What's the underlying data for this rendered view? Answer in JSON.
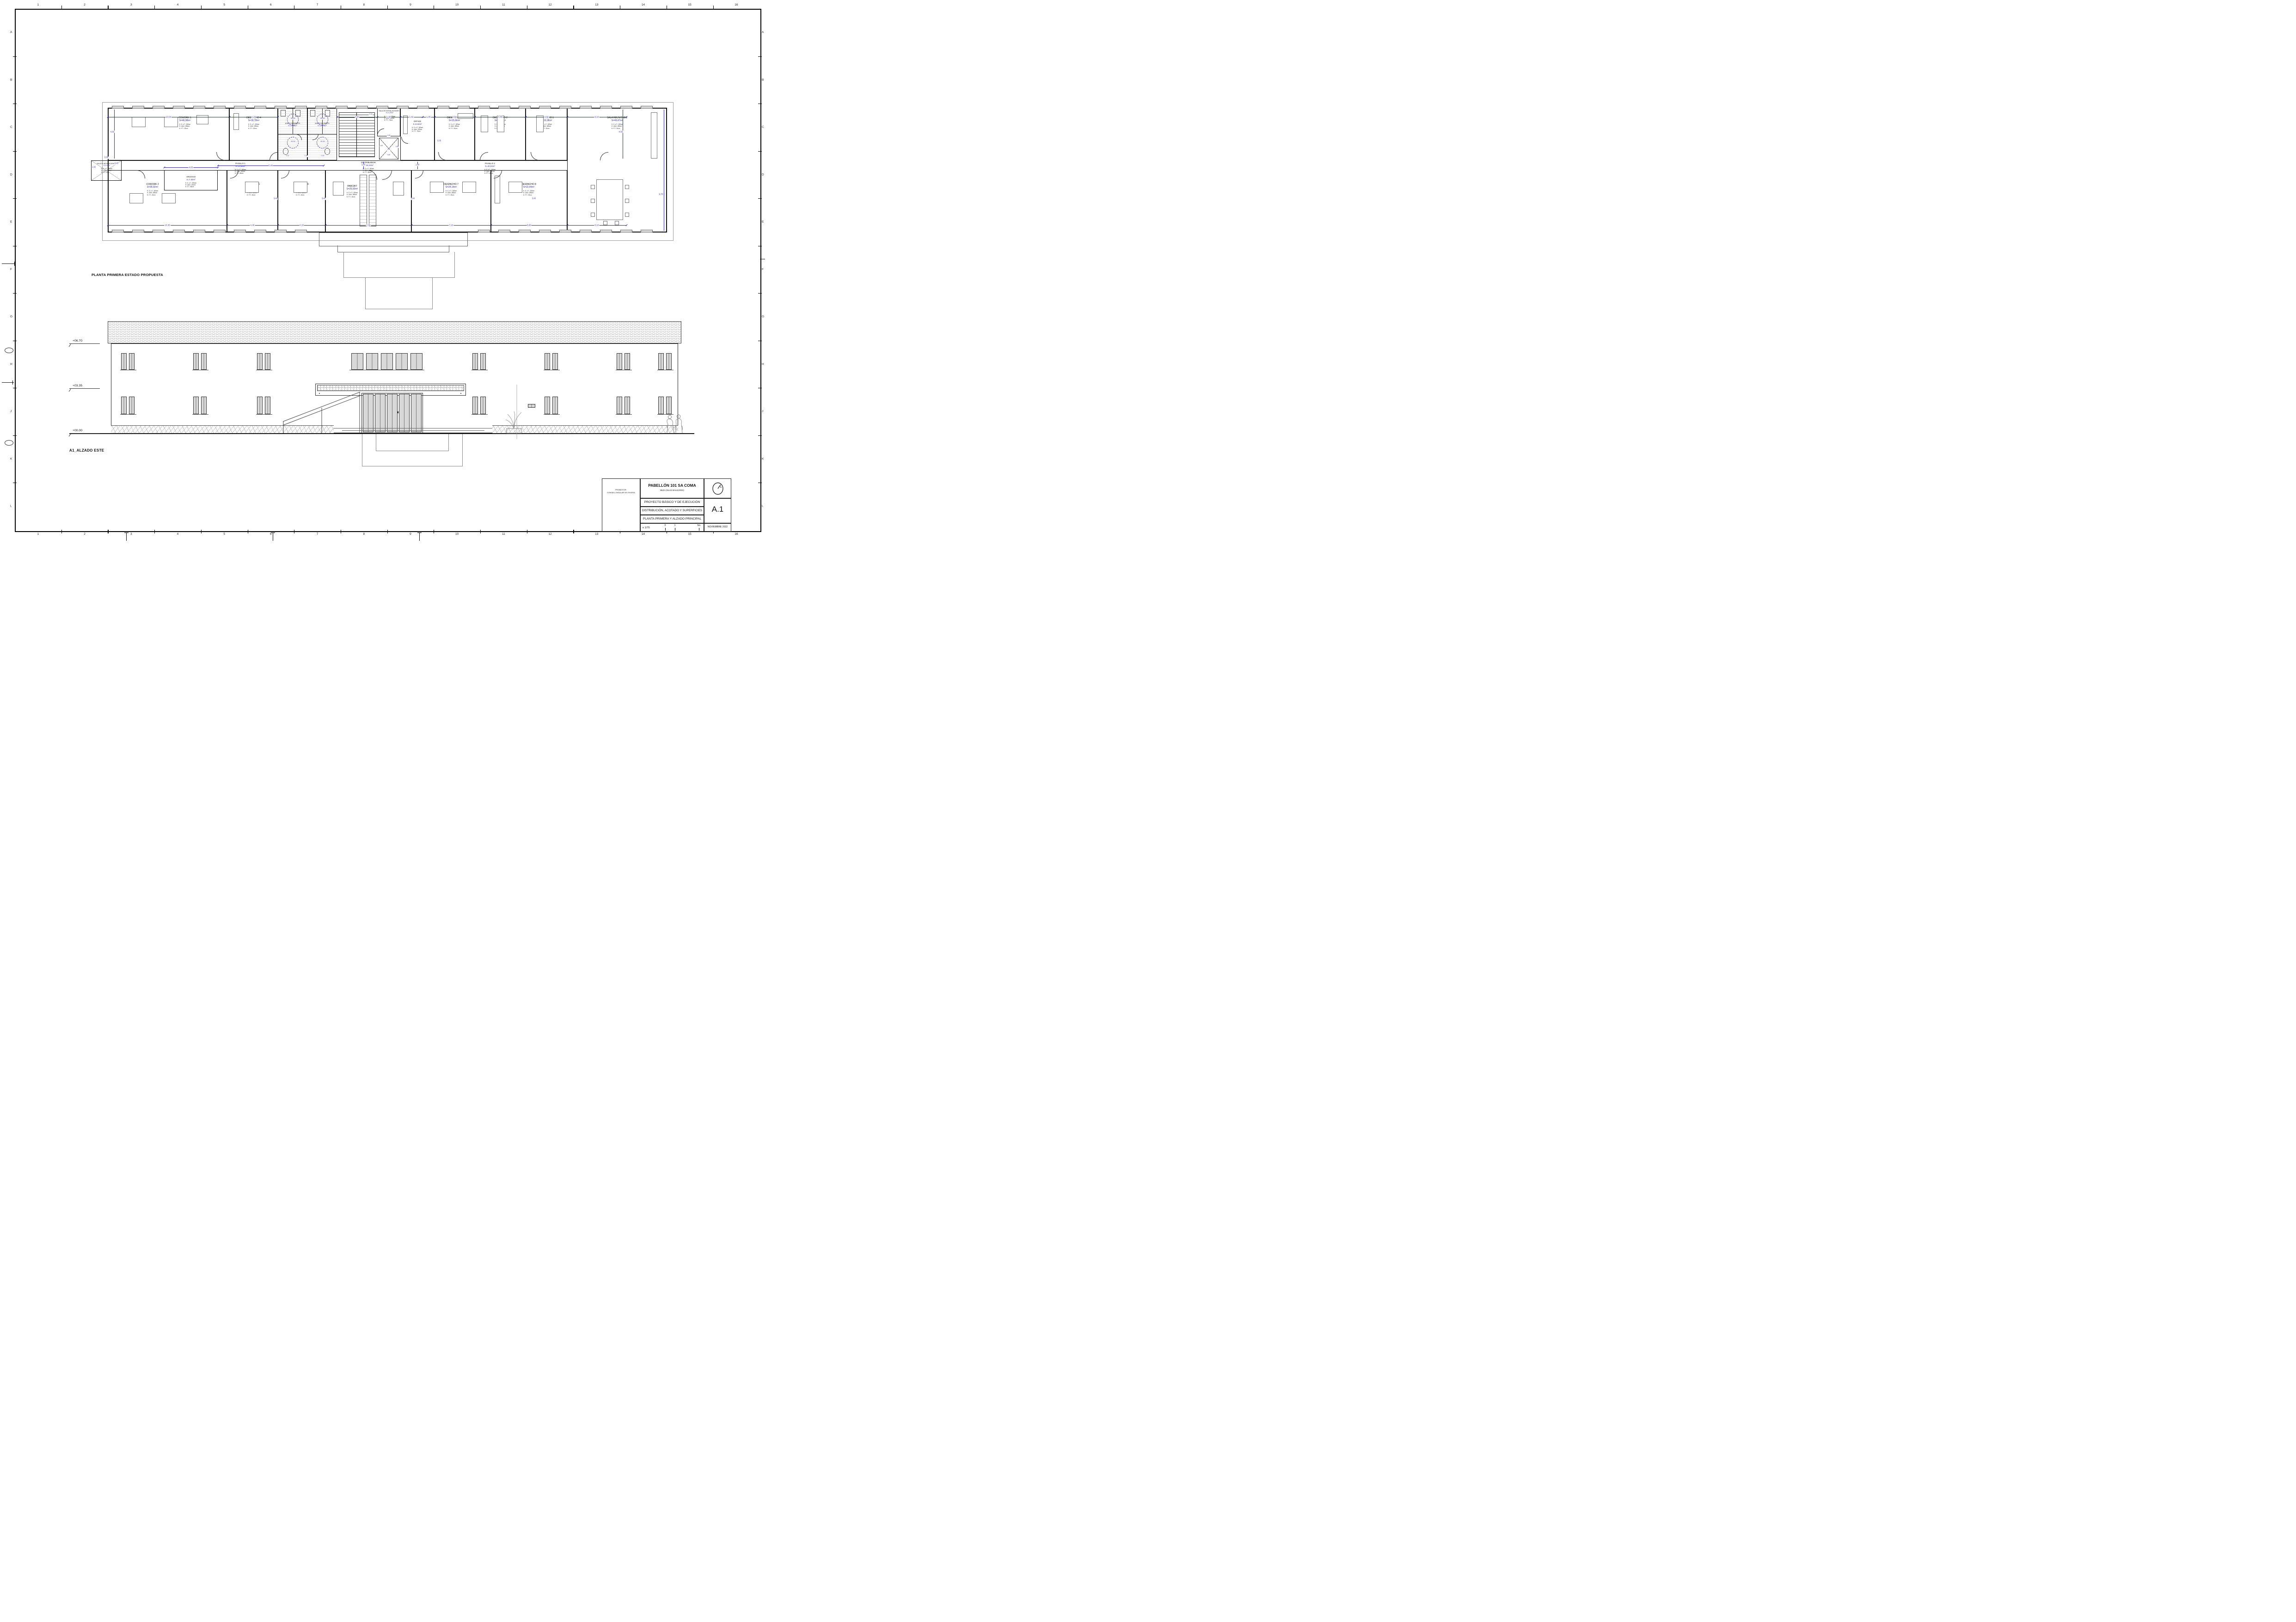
{
  "sheet": {
    "grid_numbers": [
      "1",
      "2",
      "3",
      "4",
      "5",
      "6",
      "7",
      "8",
      "9",
      "10",
      "11",
      "12",
      "13",
      "14",
      "15",
      "16"
    ],
    "grid_letters": [
      "A",
      "B",
      "C",
      "D",
      "E",
      "F",
      "G",
      "H",
      "J",
      "K",
      "L"
    ]
  },
  "plan": {
    "title": "PLANTA PRIMERA ESTADO PROPUESTA",
    "rooms": [
      {
        "name": "COWORK 1",
        "area": "S=46,98m²",
        "h1": "H. S. a T.: 305cm",
        "h2": "H. Libre: 285cm",
        "h3": "H. F.T.: 20cm"
      },
      {
        "name": "DESPACHO 4",
        "area": "S=18,78m²",
        "h1": "H. S. a T.: 305cm",
        "h2": "H. Libre: 285cm",
        "h3": "H. F.T.: 20cm"
      },
      {
        "name": "ASEO HOMBRES",
        "area": "S=13,55m²",
        "h1": "",
        "h2": "",
        "h3": ""
      },
      {
        "name": "ASEO MUJERES",
        "area": "S=13,15m²",
        "h1": "",
        "h2": "",
        "h3": ""
      },
      {
        "name": "SALA DE INSTALACIONES 2",
        "area": "S=4,25m²",
        "h1": "H. S. a T.: 305cm",
        "h2": "H. Libre: 230cm",
        "h3": "H. F.T.: 75cm"
      },
      {
        "name": "OFFICE",
        "area": "S=8,64m²",
        "h1": "H. S. a T.: 305cm",
        "h2": "H. Libre: 230cm",
        "h3": "H. F.T.: 75cm"
      },
      {
        "name": "DESPACHO 3",
        "area": "S=15,66m²",
        "h1": "H. S. a T.: 305cm",
        "h2": "H. Libre: 285cm",
        "h3": "H. F.T.: 20cm"
      },
      {
        "name": "DESPACHO 2",
        "area": "S=19,68m²",
        "h1": "H. S. a T.: 305cm",
        "h2": "H. Libre: 285cm",
        "h3": "H. F.T.: 20cm"
      },
      {
        "name": "DESPACHO 1",
        "area": "S=16,08m²",
        "h1": "H. S. a T.: 305cm",
        "h2": "H. Libre: 285cm",
        "h3": "H. F.T.: 20cm"
      },
      {
        "name": "SALA REUNIONES",
        "area": "S=49,47m²",
        "h1": "H. S. a T.: 305cm",
        "h2": "H. Libre: 285cm",
        "h3": "H. F.T.: 20cm"
      },
      {
        "name": "SALA DE INSTALACIONES 1",
        "area": "S=3,10m²",
        "h1": "H. S. a T.: 305cm",
        "h2": "H. Libre: 305cm",
        "h3": "H. F.T.: 0cm"
      },
      {
        "name": "ARCHIVO",
        "area": "S=7,40m²",
        "h1": "H. S. a T.: 305cm",
        "h2": "H. Libre: 240cm",
        "h3": "H. F.T.: 65cm"
      },
      {
        "name": "PASILLO 1",
        "area": "S=13,56m²",
        "h1": "H. S. a T.: 305cm",
        "h2": "H. Libre: 240cm",
        "h3": "H. F.T.: 65cm"
      },
      {
        "name": "DISTRIBUIDOR",
        "area": "S=18,44m²",
        "h1": "H. S. a T.: 305cm",
        "h2": "H. Libre: 240cm",
        "h3": "H. F.T.: 65cm"
      },
      {
        "name": "PASILLO 2",
        "area": "S=20,04m²",
        "h1": "H. S. a T.: 305cm",
        "h2": "H. Libre: 240cm",
        "h3": "H. F.T.: 65cm"
      },
      {
        "name": "COWORK 2",
        "area": "S=35,02m²",
        "h1": "H. S. a T.: 305cm",
        "h2": "H. Libre: 285cm",
        "h3": "H. F.T.: 20cm"
      },
      {
        "name": "DESPACHO 5",
        "area": "S=14,96m²",
        "h1": "H. S. a T.: 305cm",
        "h2": "H. Libre: 285cm",
        "h3": "H. F.T.: 20cm"
      },
      {
        "name": "DESPACHO 6",
        "area": "S=13,94m²",
        "h1": "H. S. a T.: 305cm",
        "h2": "H. Libre: 285cm",
        "h3": "H. F.T.: 20cm"
      },
      {
        "name": "PARCBIT",
        "area": "S=25,50m²",
        "h1": "H. S. a T.: 305cm",
        "h2": "H. Libre: 285cm",
        "h3": "H. F.T.: 20cm"
      },
      {
        "name": "DESPACHO 7",
        "area": "S=24,14m²",
        "h1": "H. S. a T.: 305cm",
        "h2": "H. Libre: 285cm",
        "h3": "H. F.T.: 20cm"
      },
      {
        "name": "DESPACHO 8",
        "area": "S=22,44m²",
        "h1": "H. S. a T.: 305cm",
        "h2": "H. Libre: 285cm",
        "h3": "H. F.T.: 20cm"
      }
    ],
    "dims": {
      "top": [
        "10,50",
        "4,20",
        "3,50",
        "1,98",
        "1,92",
        "1,05",
        "3,50",
        "4,40",
        "3,60",
        "5,10"
      ],
      "bottom": [
        "10,30",
        "4,40",
        "4,10",
        "7,50",
        "7,10",
        "6,60",
        "5,10"
      ],
      "corridor": [
        "2,59",
        "1,32",
        "4,63",
        "8,48",
        "1,60",
        "1,60"
      ],
      "left": [
        "4,50",
        "0,45"
      ],
      "right": [
        "4,50",
        "9,70"
      ],
      "inner_bottom": [
        "3,40",
        "3,40",
        "3,40",
        "3,40"
      ],
      "aseo": [
        "1,02",
        "1,50",
        "0,45"
      ],
      "diameters": [
        "Ø1,50",
        "Ø1,50",
        "Ø1,50",
        "Ø1,50"
      ],
      "lift": [
        "1,60",
        "1,40",
        "1,10",
        "0,90",
        "1,65"
      ],
      "stair": [
        "2,15",
        "3,35"
      ]
    }
  },
  "elevation": {
    "title": "A1_ALZADO ESTE",
    "levels": [
      "+06.70",
      "+03.35",
      "+00.00"
    ]
  },
  "titleblock": {
    "promotor_label": "PROMOTOR:",
    "promotor": "CONSELL INSULAR DE EIVISSA",
    "project": "PABELLÓN 101 SA COMA",
    "location": "IBIZA (ISLAS BALEARES)",
    "doc_line1": "PROYECTO BÁSICO Y DE EJECUCIÓN",
    "doc_line2": "DISTRIBUCIÓN, ACOTADO Y SUPERFICIES",
    "doc_line3": "PLANTA PRIMERA Y ALZADO PRINCIPAL",
    "sheet_code": "A.1",
    "scale": "e 1/75",
    "scale_ticks": [
      "0",
      "1",
      "5m"
    ],
    "date": "NOVIEMBRE 2022"
  }
}
